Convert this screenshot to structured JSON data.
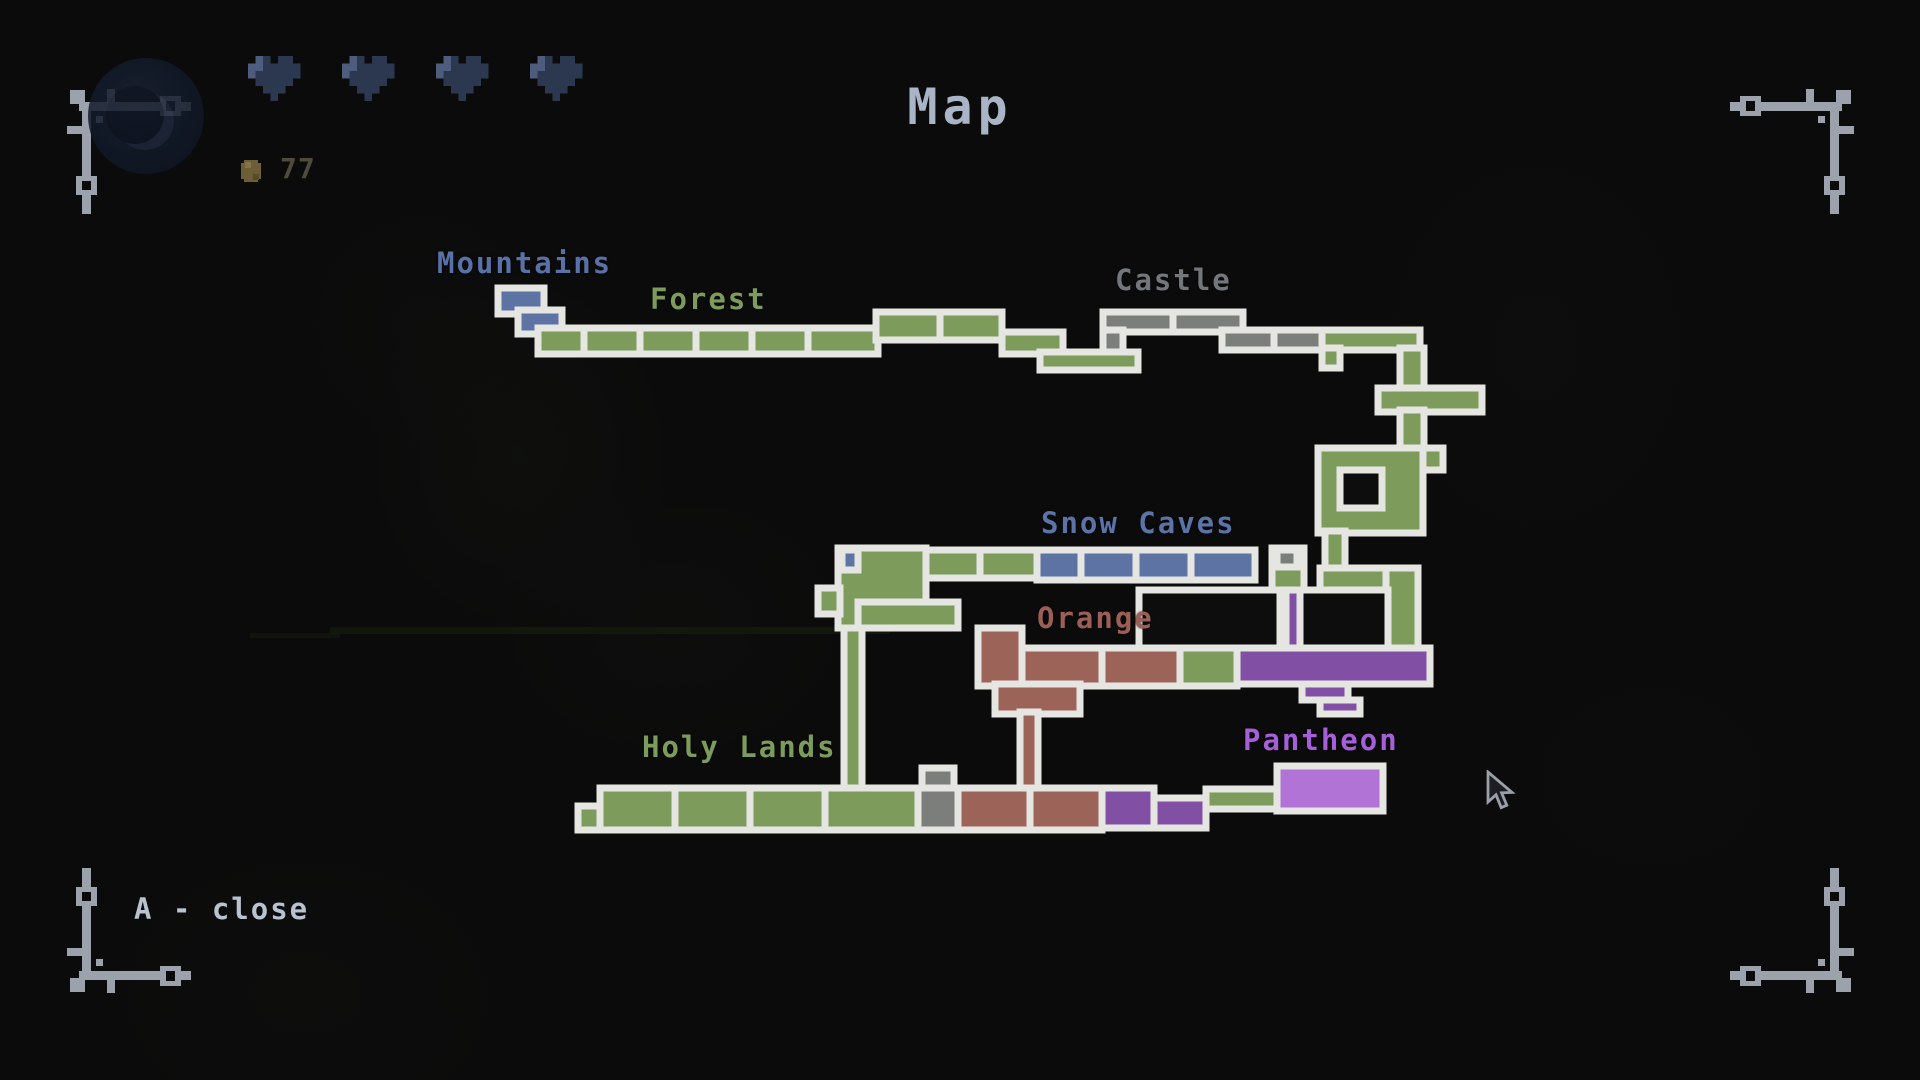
{
  "title": "Map",
  "hud": {
    "hearts": 4,
    "coin_count": "77"
  },
  "footer": {
    "close_hint": "A - close"
  },
  "palette": {
    "border": "#e5e6e2",
    "green": "#7d9c5c",
    "blue": "#5c73a4",
    "gray": "#7c7e7c",
    "brown": "#9c6358",
    "purple": "#8150a4",
    "purple_bright": "#b273d6",
    "dark": "#0d0d0d",
    "title_color": "#a9b4c6",
    "hint_color": "#b9c2cf",
    "coin_text_color": "#4f4a3a",
    "heart_color": "#2c3850",
    "heart_highlight": "#4e5d7d"
  },
  "map": {
    "labels": [
      {
        "id": "mountains",
        "text": "Mountains",
        "x": 437,
        "y": 246,
        "color": "#5a71a8"
      },
      {
        "id": "forest",
        "text": "Forest",
        "x": 650,
        "y": 282,
        "color": "#7d9c5c"
      },
      {
        "id": "castle",
        "text": "Castle",
        "x": 1115,
        "y": 263,
        "color": "#73767a"
      },
      {
        "id": "snow-caves",
        "text": "Snow Caves",
        "x": 1041,
        "y": 506,
        "color": "#5c73a8"
      },
      {
        "id": "orange",
        "text": "Orange",
        "x": 1037,
        "y": 601,
        "color": "#9c5f55"
      },
      {
        "id": "holy-lands",
        "text": "Holy Lands",
        "x": 642,
        "y": 730,
        "color": "#7d9c5c"
      },
      {
        "id": "pantheon",
        "text": "Pantheon",
        "x": 1243,
        "y": 723,
        "color": "#a55fd8"
      }
    ],
    "rooms": [
      {
        "x": 498,
        "y": 288,
        "w": 46,
        "h": 26,
        "f": "blue"
      },
      {
        "x": 518,
        "y": 310,
        "w": 44,
        "h": 24,
        "f": "blue"
      },
      {
        "x": 538,
        "y": 328,
        "w": 46,
        "h": 26,
        "f": "green"
      },
      {
        "x": 584,
        "y": 328,
        "w": 56,
        "h": 26,
        "f": "green"
      },
      {
        "x": 640,
        "y": 328,
        "w": 56,
        "h": 26,
        "f": "green"
      },
      {
        "x": 696,
        "y": 328,
        "w": 56,
        "h": 26,
        "f": "green"
      },
      {
        "x": 752,
        "y": 328,
        "w": 56,
        "h": 26,
        "f": "green"
      },
      {
        "x": 808,
        "y": 328,
        "w": 70,
        "h": 26,
        "f": "green"
      },
      {
        "x": 876,
        "y": 312,
        "w": 64,
        "h": 28,
        "f": "green"
      },
      {
        "x": 940,
        "y": 312,
        "w": 62,
        "h": 28,
        "f": "green"
      },
      {
        "x": 1002,
        "y": 332,
        "w": 61,
        "h": 22,
        "f": "green"
      },
      {
        "x": 1040,
        "y": 352,
        "w": 98,
        "h": 18,
        "f": "green"
      },
      {
        "x": 1103,
        "y": 312,
        "w": 70,
        "h": 20,
        "f": "gray"
      },
      {
        "x": 1173,
        "y": 312,
        "w": 70,
        "h": 20,
        "f": "gray"
      },
      {
        "x": 1103,
        "y": 330,
        "w": 20,
        "h": 22,
        "f": "gray"
      },
      {
        "x": 1222,
        "y": 330,
        "w": 52,
        "h": 20,
        "f": "gray"
      },
      {
        "x": 1274,
        "y": 330,
        "w": 48,
        "h": 20,
        "f": "gray"
      },
      {
        "x": 1322,
        "y": 330,
        "w": 98,
        "h": 20,
        "f": "green"
      },
      {
        "x": 1322,
        "y": 348,
        "w": 18,
        "h": 20,
        "f": "green"
      },
      {
        "x": 1400,
        "y": 348,
        "w": 24,
        "h": 42,
        "f": "green"
      },
      {
        "x": 1378,
        "y": 388,
        "w": 104,
        "h": 24,
        "f": "green"
      },
      {
        "x": 1400,
        "y": 410,
        "w": 24,
        "h": 42,
        "f": "green"
      },
      {
        "x": 1318,
        "y": 448,
        "w": 105,
        "h": 85,
        "f": "green"
      },
      {
        "x": 1423,
        "y": 448,
        "w": 20,
        "h": 22,
        "f": "green"
      },
      {
        "x": 1340,
        "y": 470,
        "w": 42,
        "h": 38,
        "f": "dark"
      },
      {
        "x": 1325,
        "y": 531,
        "w": 20,
        "h": 39,
        "f": "green"
      },
      {
        "x": 1320,
        "y": 568,
        "w": 78,
        "h": 22,
        "f": "green"
      },
      {
        "x": 1386,
        "y": 568,
        "w": 32,
        "h": 82,
        "f": "green"
      },
      {
        "x": 838,
        "y": 548,
        "w": 88,
        "h": 80,
        "f": "green"
      },
      {
        "x": 818,
        "y": 588,
        "w": 22,
        "h": 26,
        "f": "green"
      },
      {
        "x": 858,
        "y": 602,
        "w": 100,
        "h": 26,
        "f": "green"
      },
      {
        "x": 842,
        "y": 550,
        "w": 16,
        "h": 20,
        "f": "blue"
      },
      {
        "x": 926,
        "y": 550,
        "w": 54,
        "h": 28,
        "f": "green"
      },
      {
        "x": 980,
        "y": 550,
        "w": 57,
        "h": 28,
        "f": "green"
      },
      {
        "x": 1037,
        "y": 550,
        "w": 44,
        "h": 30,
        "f": "blue"
      },
      {
        "x": 1081,
        "y": 550,
        "w": 55,
        "h": 30,
        "f": "blue"
      },
      {
        "x": 1136,
        "y": 550,
        "w": 55,
        "h": 30,
        "f": "blue"
      },
      {
        "x": 1191,
        "y": 550,
        "w": 64,
        "h": 30,
        "f": "blue"
      },
      {
        "x": 1272,
        "y": 548,
        "w": 32,
        "h": 42,
        "f": "green"
      },
      {
        "x": 1277,
        "y": 550,
        "w": 20,
        "h": 17,
        "f": "gray"
      },
      {
        "x": 844,
        "y": 628,
        "w": 18,
        "h": 164,
        "f": "green"
      },
      {
        "x": 1139,
        "y": 590,
        "w": 141,
        "h": 58,
        "f": "dark"
      },
      {
        "x": 1286,
        "y": 590,
        "w": 16,
        "h": 58,
        "f": "purple"
      },
      {
        "x": 1300,
        "y": 590,
        "w": 88,
        "h": 58,
        "f": "dark"
      },
      {
        "x": 1237,
        "y": 648,
        "w": 193,
        "h": 36,
        "f": "purple"
      },
      {
        "x": 1302,
        "y": 684,
        "w": 46,
        "h": 16,
        "f": "purple"
      },
      {
        "x": 1320,
        "y": 700,
        "w": 40,
        "h": 14,
        "f": "purple"
      },
      {
        "x": 1022,
        "y": 648,
        "w": 80,
        "h": 38,
        "f": "brown"
      },
      {
        "x": 1102,
        "y": 648,
        "w": 78,
        "h": 38,
        "f": "brown"
      },
      {
        "x": 1180,
        "y": 648,
        "w": 57,
        "h": 38,
        "f": "green"
      },
      {
        "x": 978,
        "y": 628,
        "w": 44,
        "h": 58,
        "f": "brown"
      },
      {
        "x": 995,
        "y": 684,
        "w": 85,
        "h": 30,
        "f": "brown"
      },
      {
        "x": 1020,
        "y": 712,
        "w": 18,
        "h": 78,
        "f": "brown"
      },
      {
        "x": 578,
        "y": 806,
        "w": 24,
        "h": 24,
        "f": "green"
      },
      {
        "x": 600,
        "y": 788,
        "w": 75,
        "h": 42,
        "f": "green"
      },
      {
        "x": 675,
        "y": 788,
        "w": 75,
        "h": 42,
        "f": "green"
      },
      {
        "x": 750,
        "y": 788,
        "w": 75,
        "h": 42,
        "f": "green"
      },
      {
        "x": 825,
        "y": 788,
        "w": 93,
        "h": 42,
        "f": "green"
      },
      {
        "x": 922,
        "y": 768,
        "w": 32,
        "h": 22,
        "f": "gray"
      },
      {
        "x": 918,
        "y": 788,
        "w": 40,
        "h": 42,
        "f": "gray"
      },
      {
        "x": 958,
        "y": 788,
        "w": 72,
        "h": 42,
        "f": "brown"
      },
      {
        "x": 1030,
        "y": 788,
        "w": 72,
        "h": 42,
        "f": "brown"
      },
      {
        "x": 1102,
        "y": 788,
        "w": 52,
        "h": 40,
        "f": "purple"
      },
      {
        "x": 1154,
        "y": 798,
        "w": 52,
        "h": 30,
        "f": "purple"
      },
      {
        "x": 1206,
        "y": 789,
        "w": 74,
        "h": 20,
        "f": "green"
      },
      {
        "x": 1277,
        "y": 766,
        "w": 106,
        "h": 45,
        "f": "purple_bright"
      }
    ]
  },
  "cursor": {
    "x": 1484,
    "y": 770
  }
}
